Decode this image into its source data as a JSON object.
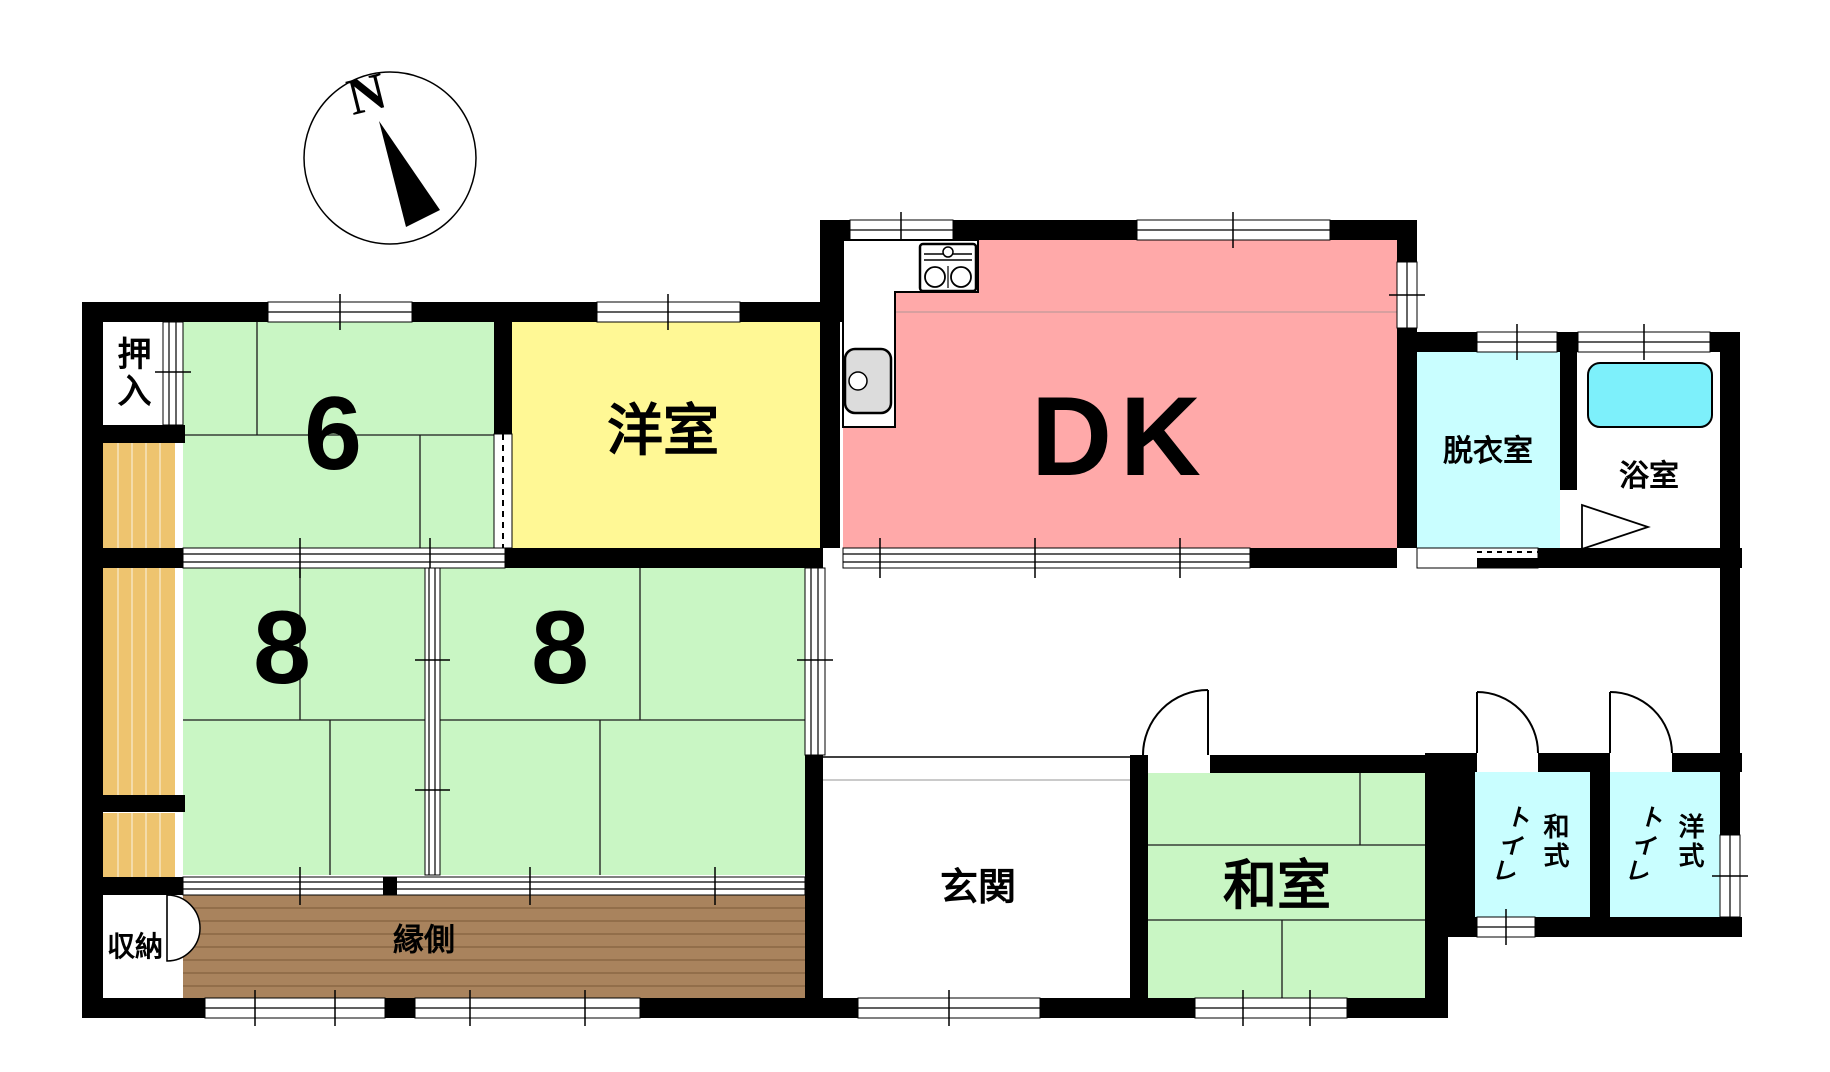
{
  "compass": {
    "label": "N"
  },
  "colors": {
    "tatami_green": "#c9f6c4",
    "western_yellow": "#fff895",
    "dk_pink": "#ffa9a9",
    "wet_cyan": "#c9feff",
    "tub_cyan": "#7df0fb",
    "corridor_tan": "#eec46f",
    "veranda_brown": "#a9835d",
    "wall": "#000000"
  },
  "rooms": {
    "oshiire": {
      "label": "押入"
    },
    "tatami6": {
      "label": "6"
    },
    "youshitsu": {
      "label": "洋室"
    },
    "dk": {
      "label": "DK"
    },
    "datsuishitsu": {
      "label": "脱衣室"
    },
    "yokushitsu": {
      "label": "浴室"
    },
    "tatami8_left": {
      "label": "8"
    },
    "tatami8_right": {
      "label": "8"
    },
    "genkan": {
      "label": "玄関"
    },
    "washitsu": {
      "label": "和室"
    },
    "engawa": {
      "label": "縁側"
    },
    "shuunou": {
      "label": "収納"
    },
    "toilet_japanese": {
      "type_label": "和式",
      "toilet_label": "トイレ"
    },
    "toilet_western": {
      "type_label": "洋式",
      "toilet_label": "トイレ"
    }
  }
}
